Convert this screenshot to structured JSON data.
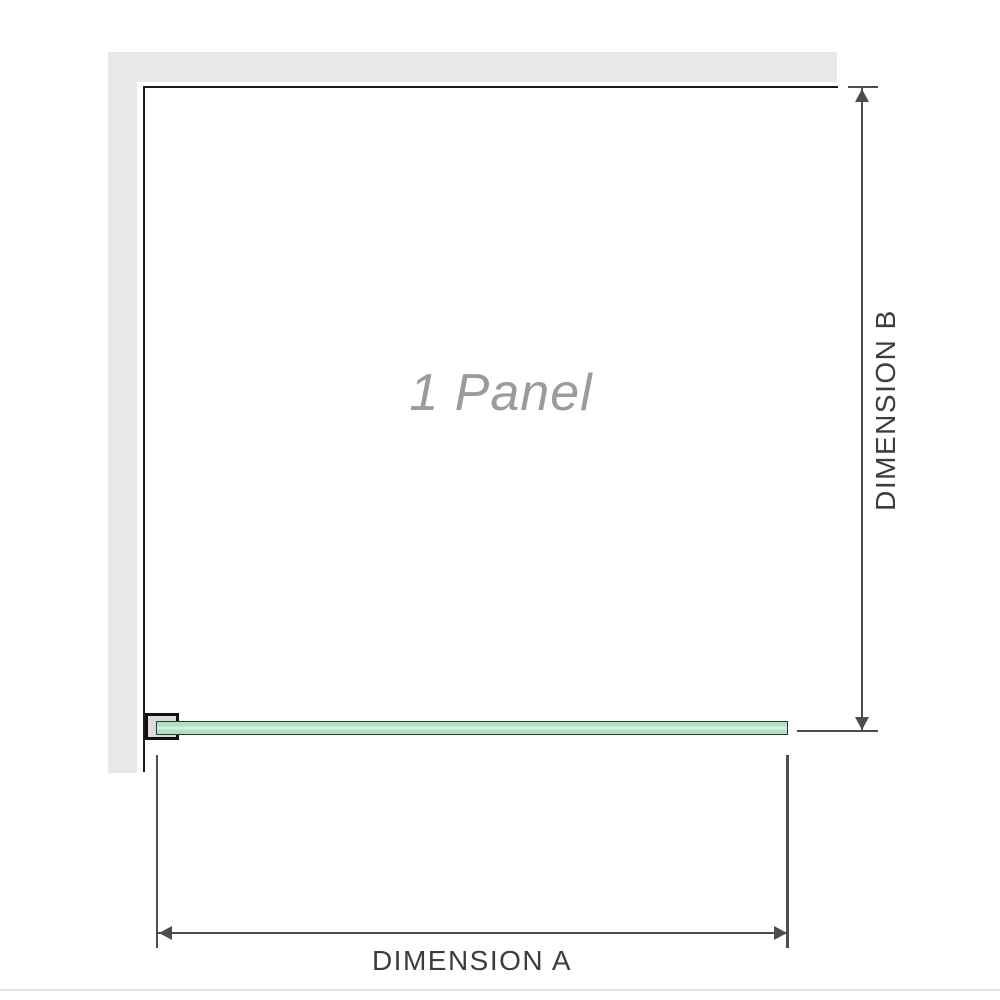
{
  "diagram": {
    "panel_label": "1 Panel",
    "dimensions": {
      "a_label": "DIMENSION A",
      "b_label": "DIMENSION B"
    }
  },
  "colors": {
    "wall": "#e9e9e9",
    "wall_edge": "#1b1b1b",
    "glass_fill": "#aee0c2",
    "glass_highlight": "#ddf4e6",
    "glass_border": "#2a3a30",
    "bracket_fill": "#dcdcdc",
    "bracket_border": "#111111",
    "dimension_line": "#4d4d4d",
    "label_text": "#3d3d3d",
    "panel_label_text": "#9b9b9b",
    "baseline": "#e3e3df"
  }
}
